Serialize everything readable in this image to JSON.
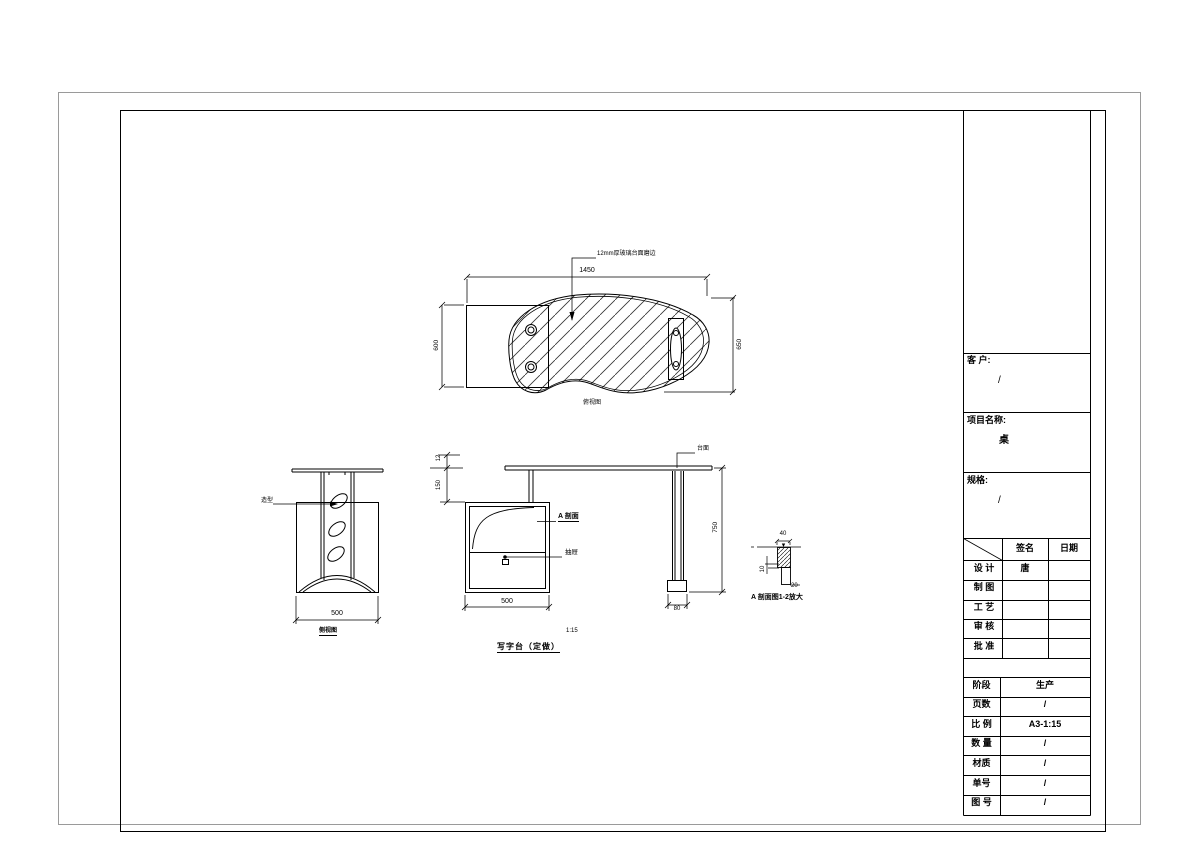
{
  "drawing": {
    "top_view": {
      "note": "12mm厚玻璃台面磨边",
      "dim_width": "1450",
      "dim_left": "600",
      "dim_right": "650",
      "caption": "俯视图"
    },
    "panel_view": {
      "note": "造型",
      "dim_width": "500",
      "caption": "侧视图"
    },
    "front_view": {
      "dim_thickness": "12",
      "dim_gap": "150",
      "section_label": "A 剖面",
      "drawer_label": "抽屉",
      "dim_width": "500",
      "scale_note": "1:15",
      "title": "写字台（定做）"
    },
    "leg_view": {
      "note": "台面",
      "dim_height": "750",
      "dim_foot": "80"
    },
    "detail_view": {
      "dim_top": "40",
      "dim_left": "10",
      "dim_right": "20",
      "caption": "A 剖面图1-2放大"
    }
  },
  "title_block": {
    "client_label": "客 户:",
    "client_value": "/",
    "project_label": "项目名称:",
    "project_value": "桌",
    "spec_label": "规格:",
    "spec_value": "/",
    "sign_col": "签名",
    "date_col": "日期",
    "sign_rows": [
      {
        "label": "设 计",
        "sign": "唐"
      },
      {
        "label": "制 图",
        "sign": ""
      },
      {
        "label": "工 艺",
        "sign": ""
      },
      {
        "label": "审 核",
        "sign": ""
      },
      {
        "label": "批 准",
        "sign": ""
      }
    ],
    "info_rows": [
      {
        "label": "阶段",
        "value": "生产"
      },
      {
        "label": "页数",
        "value": "/"
      },
      {
        "label": "比 例",
        "value": "A3-1:15"
      },
      {
        "label": "数 量",
        "value": "/"
      },
      {
        "label": "材质",
        "value": "/"
      },
      {
        "label": "单号",
        "value": "/"
      },
      {
        "label": "图 号",
        "value": "/"
      }
    ]
  }
}
